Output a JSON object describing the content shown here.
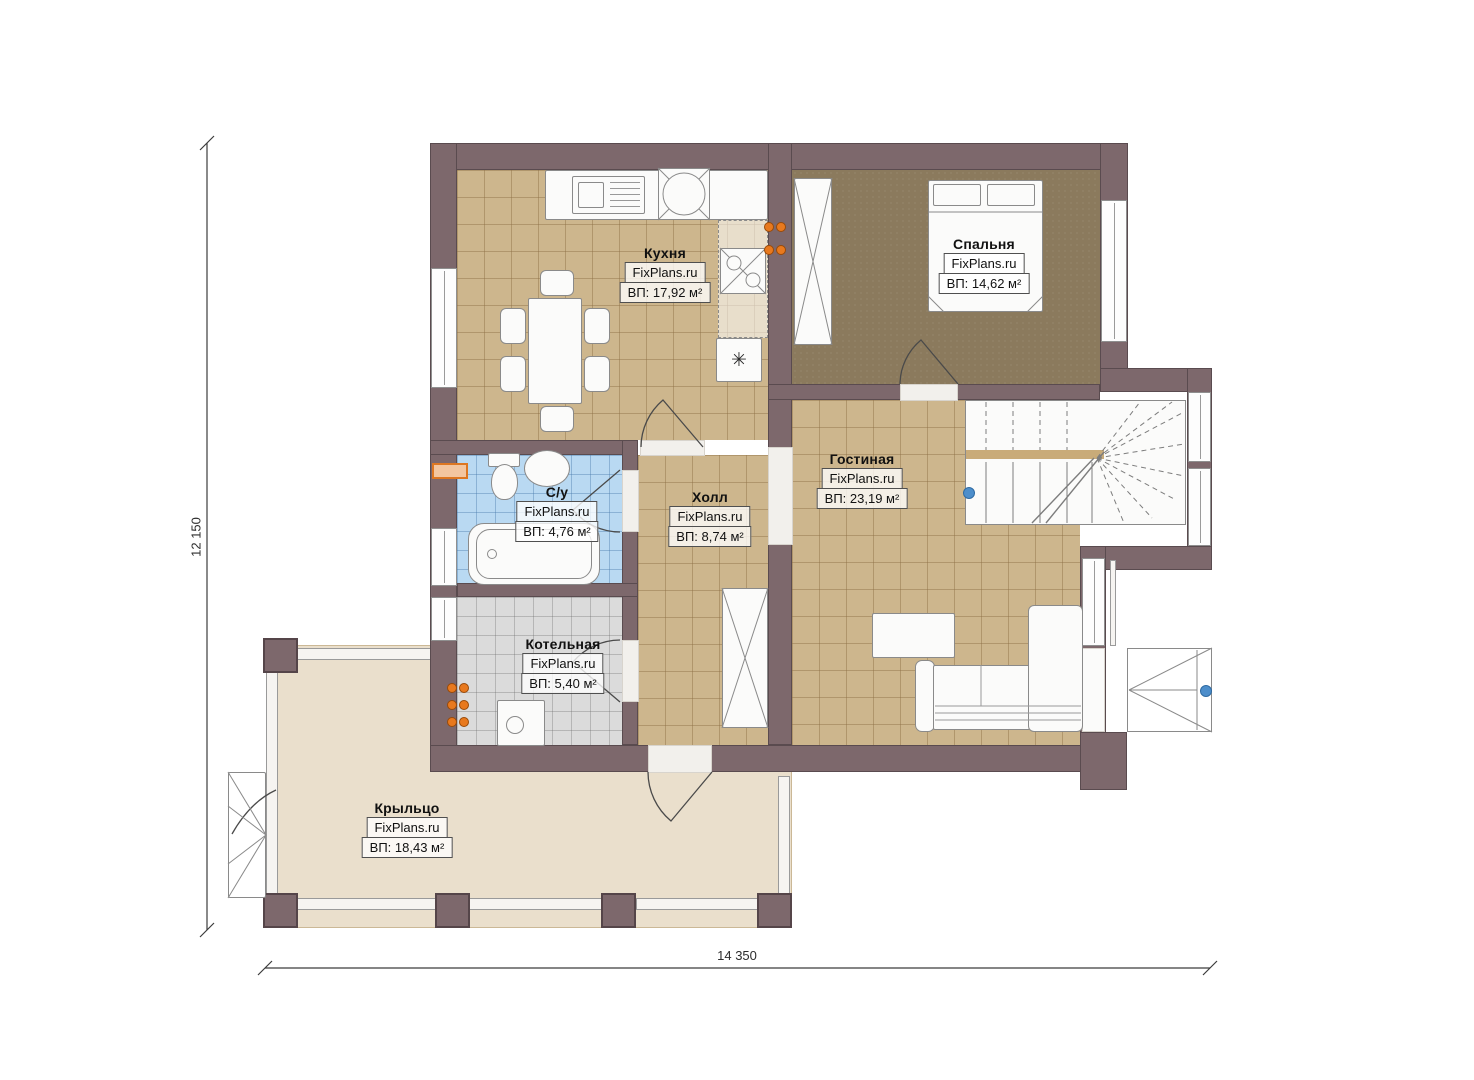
{
  "plan": {
    "source_watermark": "FixPlans.ru",
    "dimensions": {
      "height_label": "12 150",
      "width_label": "14 350"
    },
    "rooms": {
      "kitchen": {
        "name": "Кухня",
        "watermark": "FixPlans.ru",
        "area": "ВП: 17,92 м²"
      },
      "bedroom": {
        "name": "Спальня",
        "watermark": "FixPlans.ru",
        "area": "ВП: 14,62 м²"
      },
      "bathroom": {
        "name": "С/у",
        "watermark": "FixPlans.ru",
        "area": "ВП: 4,76 м²"
      },
      "hall": {
        "name": "Холл",
        "watermark": "FixPlans.ru",
        "area": "ВП: 8,74 м²"
      },
      "living": {
        "name": "Гостиная",
        "watermark": "FixPlans.ru",
        "area": "ВП: 23,19 м²"
      },
      "boiler": {
        "name": "Котельная",
        "watermark": "FixPlans.ru",
        "area": "ВП: 5,40 м²"
      },
      "porch": {
        "name": "Крыльцо",
        "watermark": "FixPlans.ru",
        "area": "ВП: 18,43 м²"
      }
    },
    "icons": {
      "freezer_glyph": "✳"
    },
    "colors": {
      "wall": "#7d686c",
      "floor_tile_tan": "#cdb68d",
      "floor_bedroom": "#8b7a5d",
      "floor_bathroom": "#b9d9f2",
      "floor_boiler": "#dbdbdb",
      "floor_porch": "#eadfcc",
      "accent_orange": "#e8791e",
      "marker_blue": "#4d8ecb"
    }
  }
}
